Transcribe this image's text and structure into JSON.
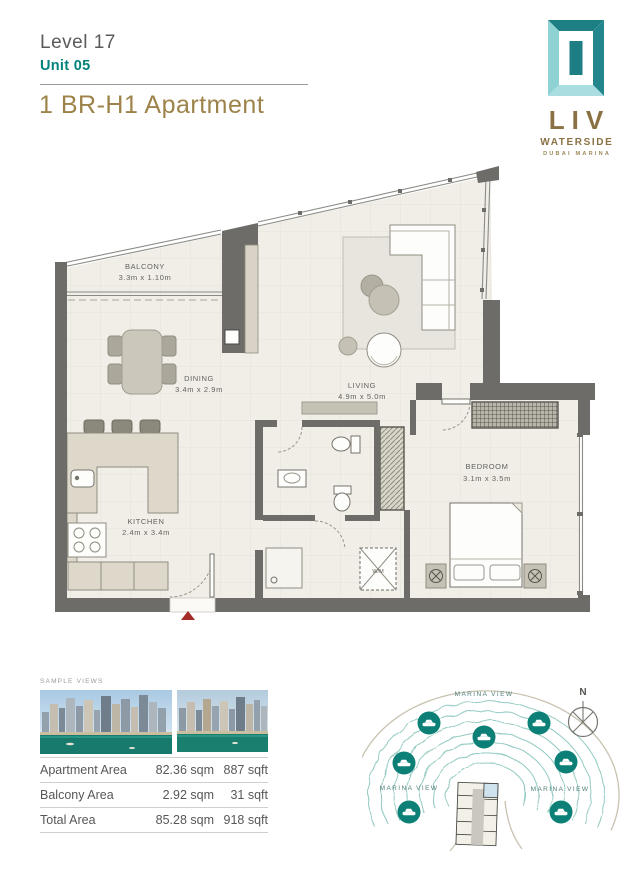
{
  "header": {
    "level": "Level 17",
    "unit": "Unit 05",
    "title": "1 BR-H1 Apartment"
  },
  "logo": {
    "brand": "LIV",
    "sub": "WATERSIDE",
    "tagline": "DUBAI MARINA"
  },
  "floorplan": {
    "balcony": {
      "name": "BALCONY",
      "dims": "3.3m x 1.10m"
    },
    "dining": {
      "name": "DINING",
      "dims": "3.4m x 2.9m"
    },
    "living": {
      "name": "LIVING",
      "dims": "4.9m x 5.0m"
    },
    "kitchen": {
      "name": "KITCHEN",
      "dims": "2.4m x 3.4m"
    },
    "bedroom": {
      "name": "BEDROOM",
      "dims": "3.1m x 3.5m"
    },
    "wm": "W/M"
  },
  "sample_views": {
    "label": "SAMPLE VIEWS"
  },
  "area_table": {
    "rows": [
      {
        "label": "Apartment Area",
        "sqm": "82.36 sqm",
        "sqft": "887 sqft"
      },
      {
        "label": "Balcony Area",
        "sqm": "2.92 sqm",
        "sqft": "31 sqft"
      },
      {
        "label": "Total Area",
        "sqm": "85.28 sqm",
        "sqft": "918 sqft"
      }
    ]
  },
  "view_map": {
    "label_top": "MARINA VIEW",
    "label_left": "MARINA VIEW",
    "label_right": "MARINA VIEW",
    "compass_n": "N"
  },
  "colors": {
    "teal": "#00837C",
    "gold": "#9D8349",
    "wall_gray": "#6D6C68",
    "floor_cream": "#F0EEE7",
    "badge_teal": "#0C8077",
    "highlight_unit_blue": "#CFE3EF",
    "entrance_marker_red": "#A32C26"
  }
}
